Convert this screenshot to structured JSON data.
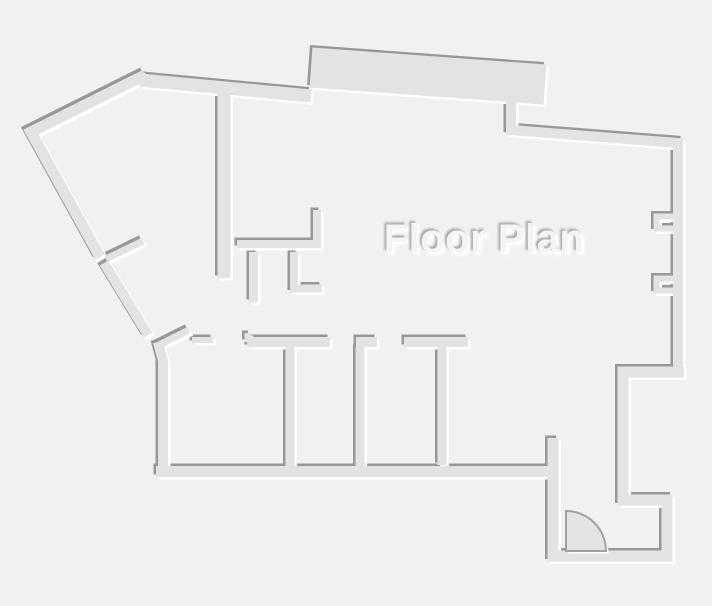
{
  "title": {
    "text": "Floor Plan"
  },
  "colors": {
    "background": "#f0f1f1",
    "wall_fill": "#e2e4e4",
    "wall_shadow_dark": "#97989a",
    "wall_highlight": "#ffffff",
    "door_outline": "#9fa0a2",
    "title_text": "#f3f4f4",
    "title_shadow_dark": "#a6a8aa",
    "title_highlight": "#ffffff"
  },
  "icons": {
    "door": {
      "name": "door-swing-icon",
      "shape": "quarter-circle-arc"
    }
  }
}
